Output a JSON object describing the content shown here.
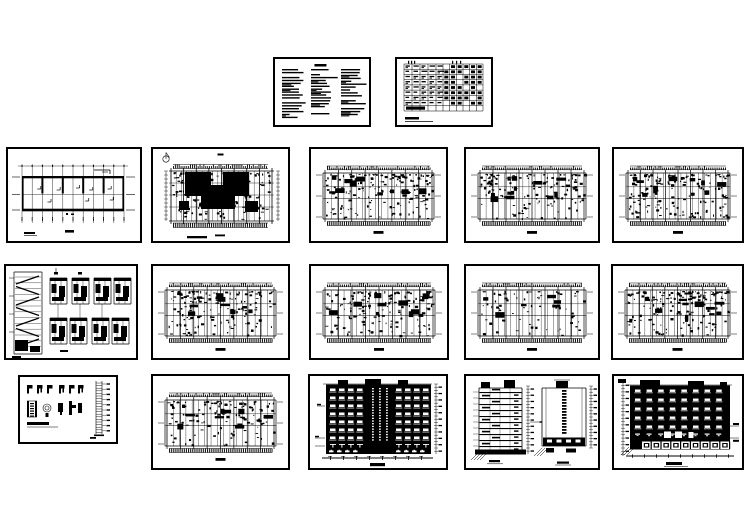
{
  "meta": {
    "background_color": "#ffffff",
    "ink_color": "#000000",
    "description": "Collage of 17 architectural CAD drawing sheets (black linework on white): design notes, door-window schedule, floor plans, stair details, construction details, elevations and sections"
  },
  "panels": [
    {
      "id": "notes",
      "label": "design-notes-sheet",
      "kind": "notes",
      "seed": 11
    },
    {
      "id": "schedule",
      "label": "door-window-schedule",
      "kind": "schedule",
      "seed": 12
    },
    {
      "id": "plan1",
      "label": "roof-framing-plan",
      "kind": "plan-simple",
      "seed": 21
    },
    {
      "id": "plan2",
      "label": "site-floor-plan",
      "kind": "plan-u",
      "seed": 22
    },
    {
      "id": "plan3",
      "label": "floor-plan",
      "kind": "plan-dense",
      "seed": 23,
      "d": 1.0
    },
    {
      "id": "plan4",
      "label": "floor-plan",
      "kind": "plan-dense",
      "seed": 24,
      "d": 0.9
    },
    {
      "id": "plan5",
      "label": "floor-plan",
      "kind": "plan-dense",
      "seed": 25,
      "d": 1.0
    },
    {
      "id": "stairs",
      "label": "stair-section-and-details",
      "kind": "stair-details",
      "seed": 31
    },
    {
      "id": "plan6",
      "label": "floor-plan",
      "kind": "plan-dense",
      "seed": 32,
      "d": 1.0
    },
    {
      "id": "plan7",
      "label": "floor-plan",
      "kind": "plan-dense",
      "seed": 33,
      "d": 0.95
    },
    {
      "id": "plan8",
      "label": "floor-plan-sparse",
      "kind": "plan-dense",
      "seed": 34,
      "d": 0.45
    },
    {
      "id": "plan9",
      "label": "floor-plan",
      "kind": "plan-dense",
      "seed": 35,
      "d": 1.0
    },
    {
      "id": "details",
      "label": "construction-details",
      "kind": "details-sheet",
      "seed": 41
    },
    {
      "id": "plan10",
      "label": "floor-plan",
      "kind": "plan-dense",
      "seed": 42,
      "d": 0.8
    },
    {
      "id": "elevfront",
      "label": "front-elevation",
      "kind": "elevation-front",
      "seed": 43
    },
    {
      "id": "sections",
      "label": "building-sections",
      "kind": "sections",
      "seed": 44
    },
    {
      "id": "elevside",
      "label": "rear-elevation",
      "kind": "elevation-side",
      "seed": 45
    }
  ]
}
